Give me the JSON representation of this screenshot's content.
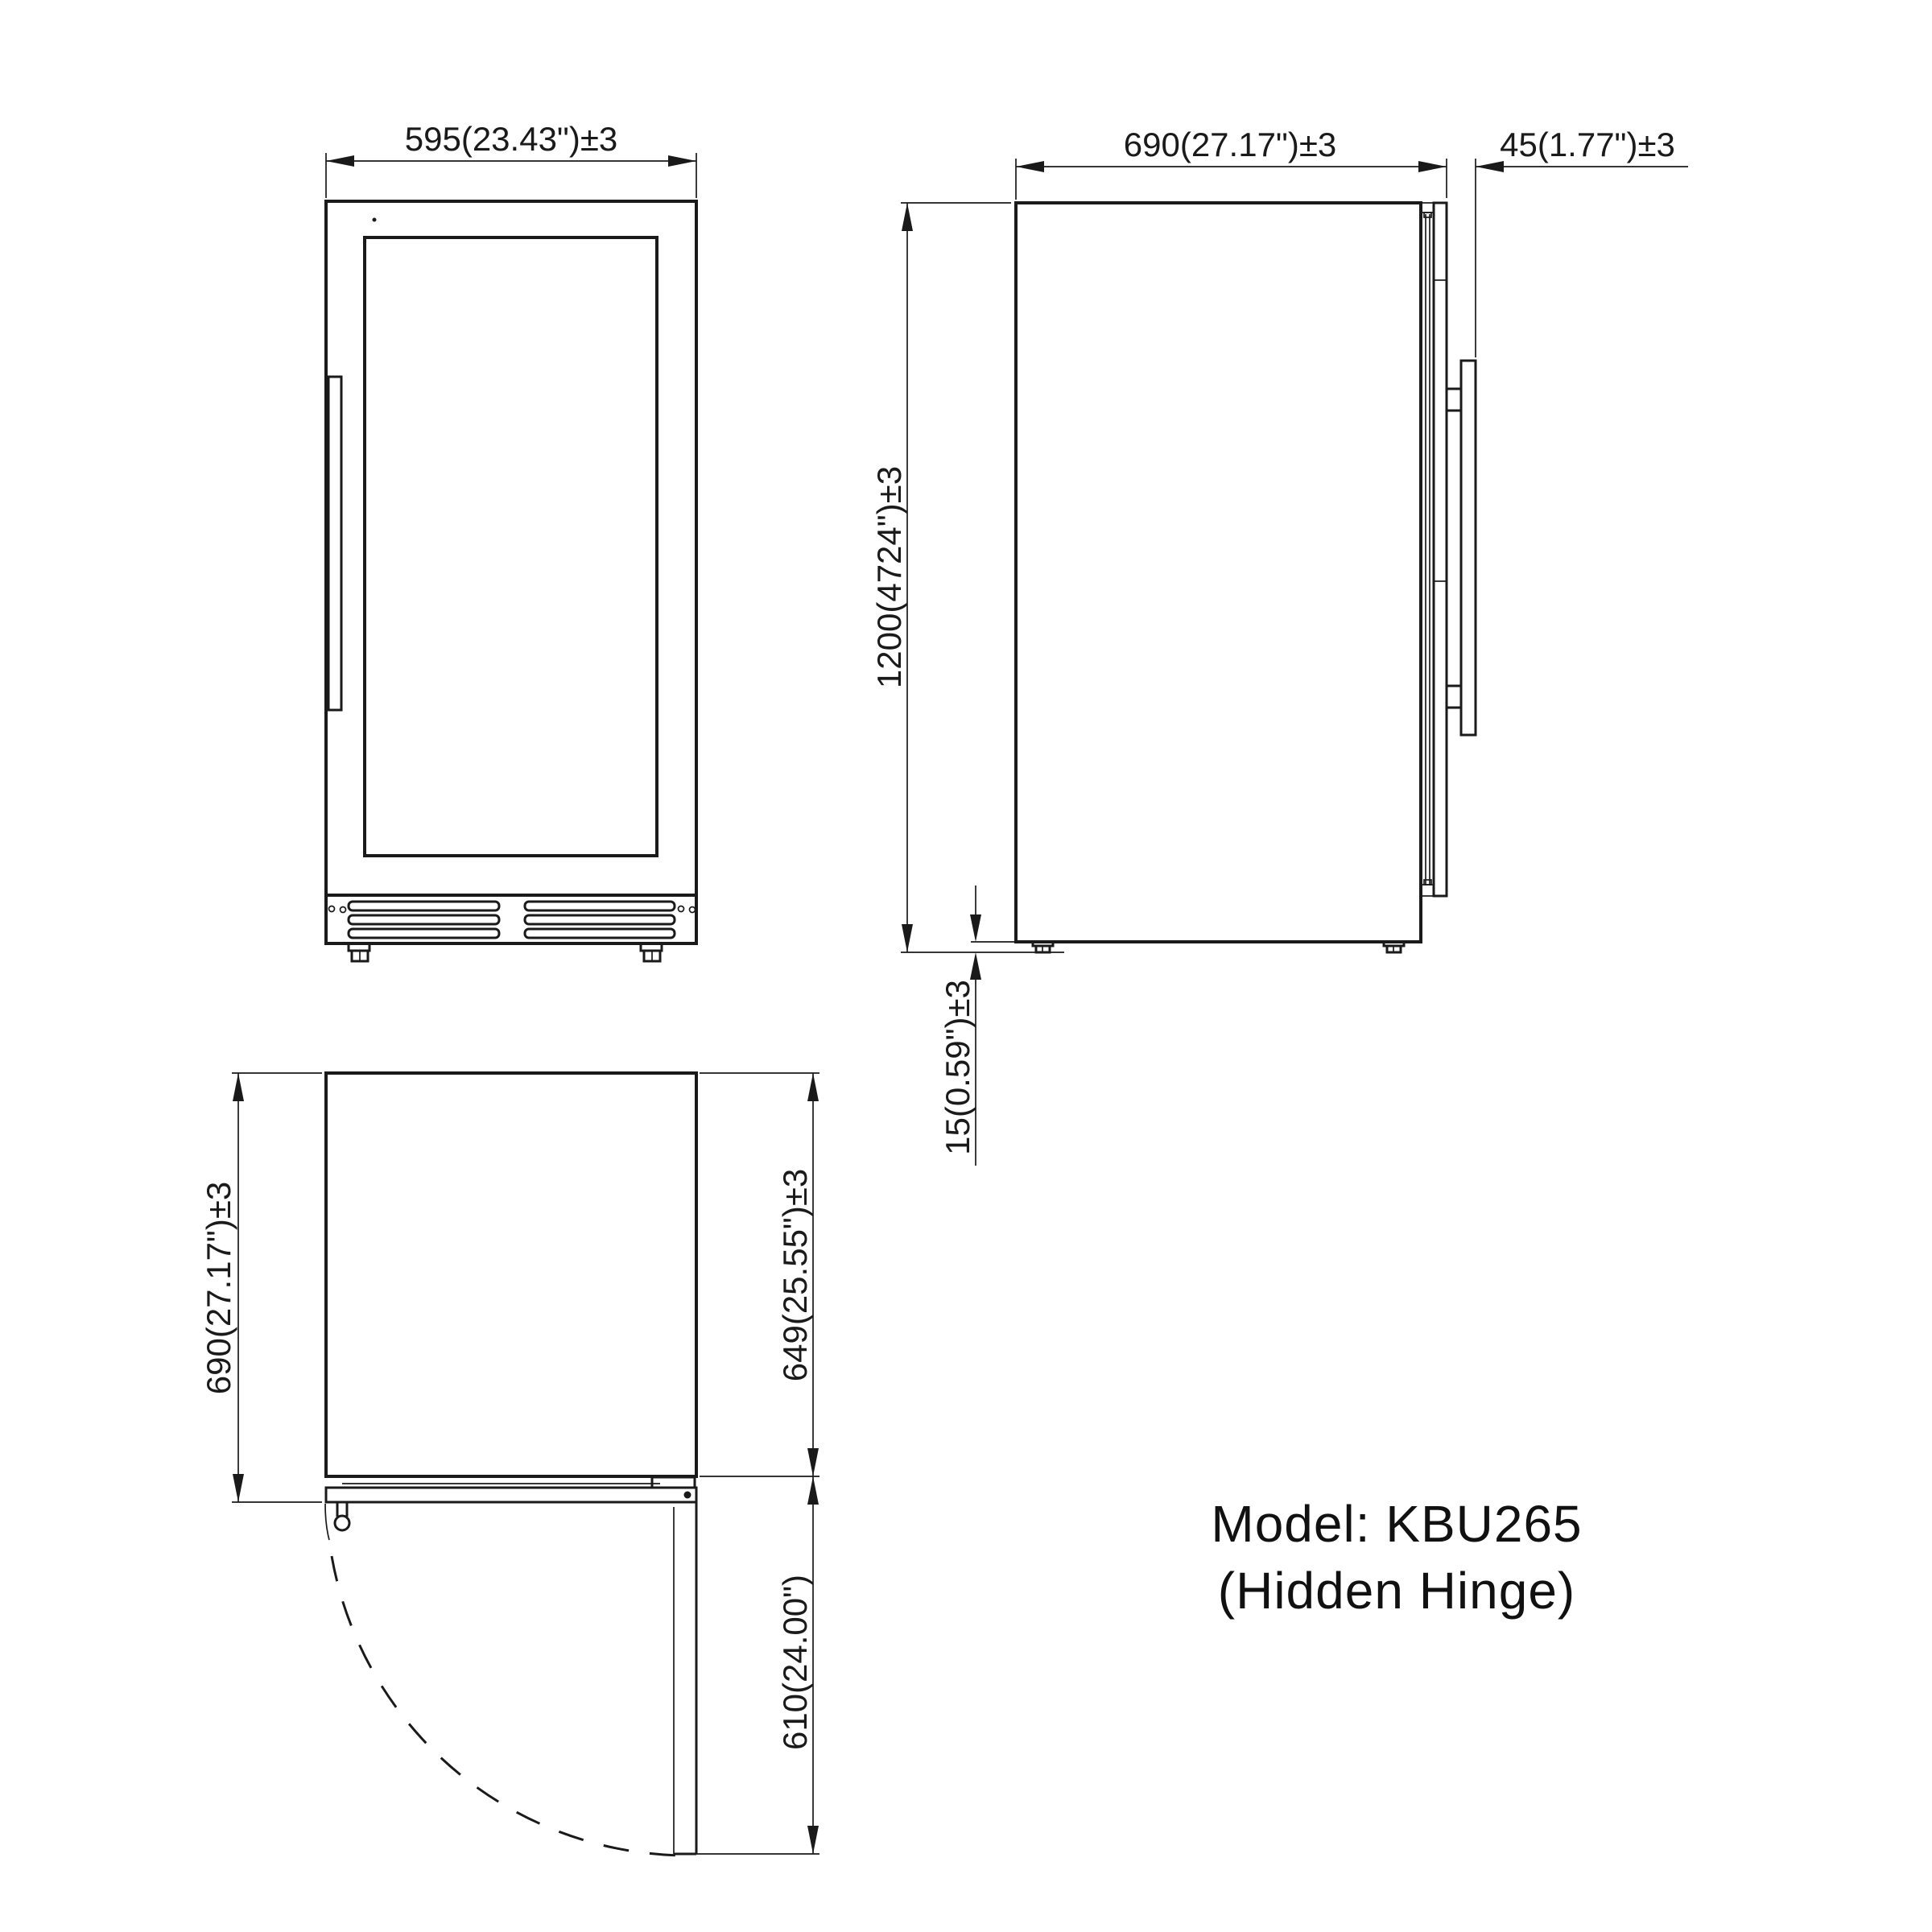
{
  "page": {
    "background": "#ffffff",
    "line_color": "#1a1a1a"
  },
  "title": {
    "line1": "Model: KBU265",
    "line2": "(Hidden Hinge)"
  },
  "front_view": {
    "width_dim": "595(23.43\")±3"
  },
  "side_view": {
    "depth_dim": "690(27.17\")±3",
    "handle_dim": "45(1.77\")±3",
    "height_dim": "1200(4724\")±3",
    "foot_dim": "15(0.59\")±3"
  },
  "plan_view": {
    "depth_dim": "690(27.17\")±3",
    "cabinet_dim": "649(25.55\")±3",
    "door_swing_dim": "610(24.00\")"
  }
}
